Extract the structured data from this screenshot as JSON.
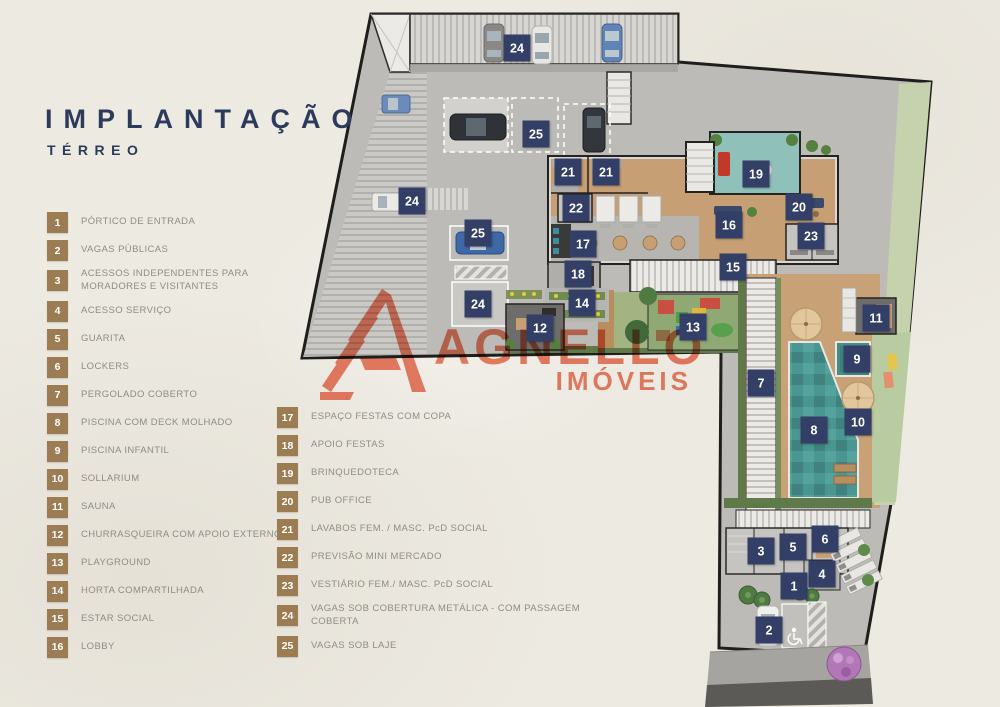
{
  "title": {
    "main": "IMPLANTAÇÃO",
    "sub": "TÉRREO"
  },
  "logo": {
    "name": "AGNELLO",
    "line2": "IMÓVEIS",
    "color": "#ee8168"
  },
  "colors": {
    "background": "#edeae2",
    "navy_title": "#2d3a5c",
    "badge_tan": "#9c7d53",
    "marker_navy": "#333f66",
    "legend_text": "#8f8c86",
    "pool_teal": "#4a9691",
    "wood_deck": "#c9a176",
    "concrete": "#bdbbb7"
  },
  "legend": {
    "column1": [
      {
        "n": "1",
        "label": "PÓRTICO DE ENTRADA"
      },
      {
        "n": "2",
        "label": "VAGAS PÚBLICAS"
      },
      {
        "n": "3",
        "label": "ACESSOS INDEPENDENTES PARA\nMORADORES E VISITANTES"
      },
      {
        "n": "4",
        "label": "ACESSO SERVIÇO"
      },
      {
        "n": "5",
        "label": "GUARITA"
      },
      {
        "n": "6",
        "label": "LOCKERS"
      },
      {
        "n": "7",
        "label": "PERGOLADO COBERTO"
      },
      {
        "n": "8",
        "label": "PISCINA COM DECK MOLHADO"
      },
      {
        "n": "9",
        "label": "PISCINA INFANTIL"
      },
      {
        "n": "10",
        "label": "SOLLARIUM"
      },
      {
        "n": "11",
        "label": "SAUNA"
      },
      {
        "n": "12",
        "label": "CHURRASQUEIRA COM APOIO EXTERNO"
      },
      {
        "n": "13",
        "label": "PLAYGROUND"
      },
      {
        "n": "14",
        "label": "HORTA COMPARTILHADA"
      },
      {
        "n": "15",
        "label": "ESTAR SOCIAL"
      },
      {
        "n": "16",
        "label": "LOBBY"
      }
    ],
    "column2": [
      {
        "n": "17",
        "label": "ESPAÇO FESTAS COM COPA"
      },
      {
        "n": "18",
        "label": "APOIO FESTAS"
      },
      {
        "n": "19",
        "label": "BRINQUEDOTECA"
      },
      {
        "n": "20",
        "label": "PUB OFFICE"
      },
      {
        "n": "21",
        "label": "LAVABOS FEM. / MASC. PcD SOCIAL"
      },
      {
        "n": "22",
        "label": "PREVISÃO MINI MERCADO"
      },
      {
        "n": "23",
        "label": "VESTIÁRIO FEM./ MASC. PcD SOCIAL"
      },
      {
        "n": "24",
        "label": "VAGAS SOB COBERTURA METÁLICA - COM PASSAGEM COBERTA"
      },
      {
        "n": "25",
        "label": "VAGAS SOB LAJE"
      }
    ]
  },
  "plan": {
    "markers": [
      {
        "n": "24",
        "x": 517,
        "y": 48
      },
      {
        "n": "25",
        "x": 536,
        "y": 134
      },
      {
        "n": "21",
        "x": 568,
        "y": 172
      },
      {
        "n": "21",
        "x": 606,
        "y": 172
      },
      {
        "n": "24",
        "x": 412,
        "y": 201
      },
      {
        "n": "22",
        "x": 576,
        "y": 208
      },
      {
        "n": "25",
        "x": 478,
        "y": 233
      },
      {
        "n": "17",
        "x": 583,
        "y": 244
      },
      {
        "n": "18",
        "x": 578,
        "y": 274
      },
      {
        "n": "14",
        "x": 582,
        "y": 303
      },
      {
        "n": "24",
        "x": 478,
        "y": 304
      },
      {
        "n": "12",
        "x": 540,
        "y": 328
      },
      {
        "n": "19",
        "x": 756,
        "y": 174
      },
      {
        "n": "20",
        "x": 799,
        "y": 207
      },
      {
        "n": "16",
        "x": 729,
        "y": 225
      },
      {
        "n": "23",
        "x": 811,
        "y": 236
      },
      {
        "n": "15",
        "x": 733,
        "y": 267
      },
      {
        "n": "13",
        "x": 693,
        "y": 327
      },
      {
        "n": "7",
        "x": 761,
        "y": 383
      },
      {
        "n": "11",
        "x": 876,
        "y": 318
      },
      {
        "n": "9",
        "x": 857,
        "y": 359
      },
      {
        "n": "10",
        "x": 858,
        "y": 422
      },
      {
        "n": "8",
        "x": 814,
        "y": 430
      },
      {
        "n": "3",
        "x": 761,
        "y": 551
      },
      {
        "n": "5",
        "x": 793,
        "y": 547
      },
      {
        "n": "6",
        "x": 825,
        "y": 539
      },
      {
        "n": "4",
        "x": 822,
        "y": 574
      },
      {
        "n": "1",
        "x": 794,
        "y": 586
      },
      {
        "n": "2",
        "x": 769,
        "y": 630
      }
    ]
  }
}
